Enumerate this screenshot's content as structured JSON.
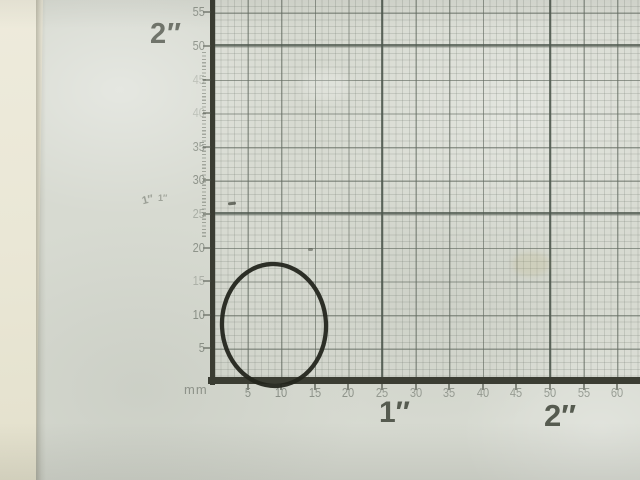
{
  "ruler": {
    "unit_label": "mm",
    "x_axis_numbers": [
      "5",
      "10",
      "15",
      "20",
      "25",
      "30",
      "35",
      "40",
      "45",
      "50",
      "55",
      "60"
    ],
    "y_axis_numbers": [
      "5",
      "10",
      "15",
      "20",
      "25",
      "30",
      "35",
      "40",
      "45",
      "50",
      "55"
    ],
    "inch_labels": {
      "left_vertical_2in": "2″",
      "left_vertical_1in_faint": "1″",
      "bottom_1in": "1″",
      "bottom_2in": "2″"
    }
  },
  "objects": {
    "o_ring": {
      "color": "#24261e"
    }
  },
  "colors": {
    "table_surface": "#eae7d6",
    "paper": "#d7dad1",
    "grid_heavy": "#4d574d",
    "axis": "#3b3d33",
    "number_text": "#7d837a",
    "inch_label_text": "#565b50",
    "inch_label_top_text": "#70746b"
  }
}
